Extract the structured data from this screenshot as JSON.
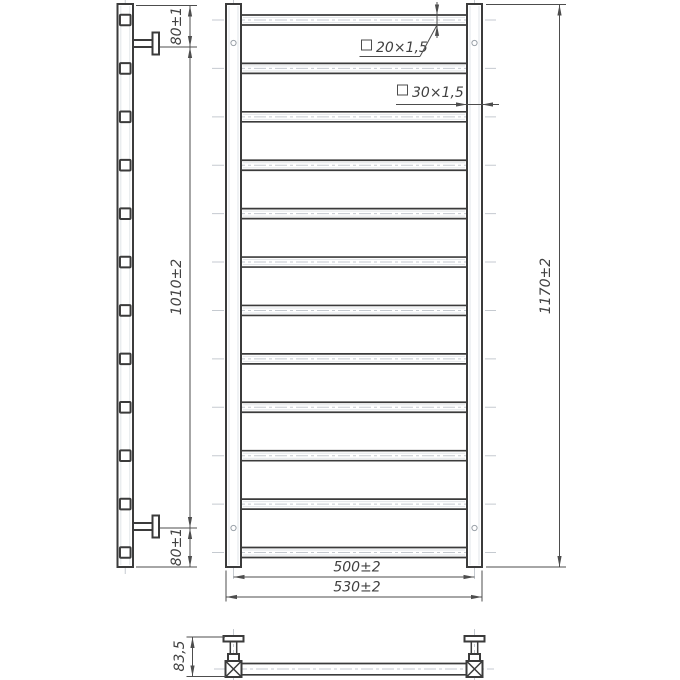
{
  "drawing": {
    "subject": "ladder-towel-rail-technical-drawing",
    "background": "#ffffff",
    "line_color": "#3b3b3b",
    "dim_color": "#4d4d4d",
    "centerline_color": "#c5cad0",
    "rung_count": 12,
    "dims": {
      "top_bracket_offset": "80±1",
      "bracket_spacing": "1010±2",
      "bottom_bracket_offset": "80±1",
      "overall_height": "1170±2",
      "rail_axis_width": "500±2",
      "overall_width": "530±2",
      "wall_depth": "83,5",
      "rung_tube_section": "20×1,5",
      "rail_tube_section": "30×1,5"
    }
  }
}
